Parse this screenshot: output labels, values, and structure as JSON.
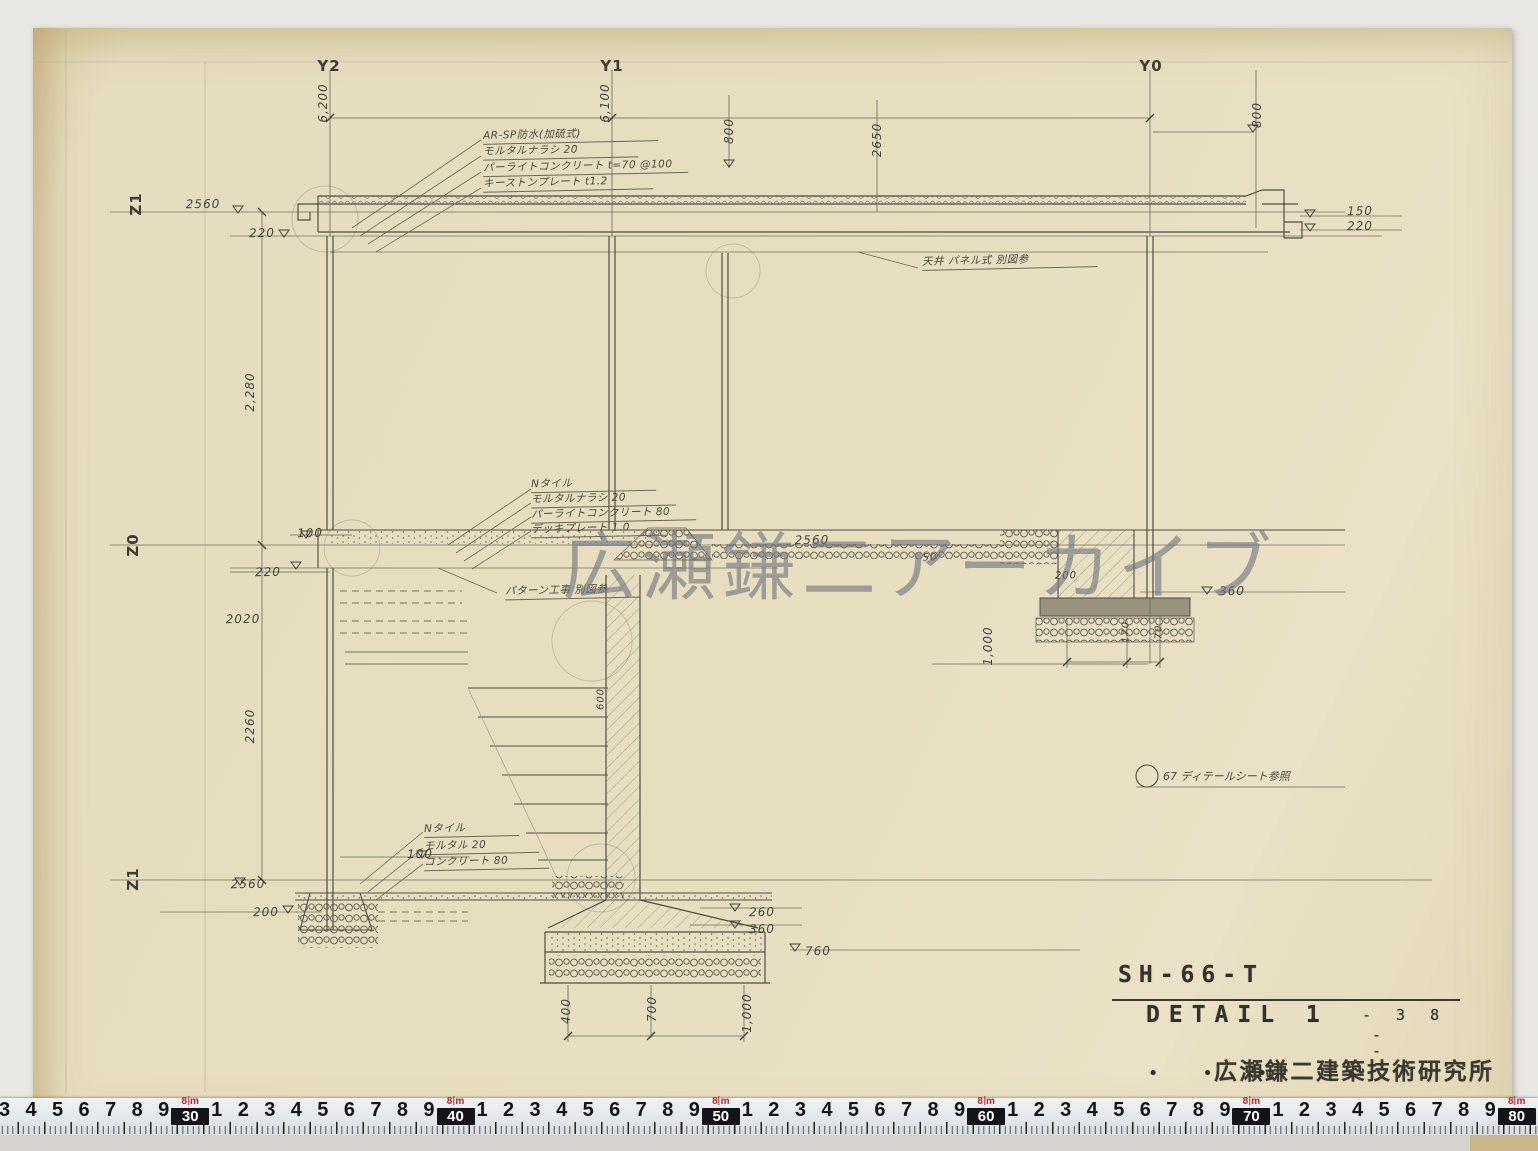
{
  "watermark": "広瀬鎌二アーカイブ",
  "grid": {
    "y2": "Y2",
    "y1": "Y1",
    "y0": "Y0",
    "z1_top": "Z1",
    "z0": "Z0",
    "z1_bot": "Z1"
  },
  "callouts": {
    "roof": [
      "AR-SP防水(加硫式)",
      "モルタルナラシ 20",
      "パーライトコンクリート t=70 @100",
      "キーストンプレート t1.2"
    ],
    "mid": [
      "Nタイル",
      "モルタルナラシ 20",
      "パーライトコンクリート 80",
      "デッキプレート 1.0"
    ],
    "ground": [
      "Nタイル",
      "モルタル 20",
      "コンクリート 80"
    ],
    "ceiling_note": "天井 パネル式 別図参",
    "pattern_note": "パターン工事 別図参",
    "detail_ref": "67 ディテールシート参照"
  },
  "dims": {
    "v6200": "6,200",
    "v6100": "6,100",
    "v800a": "800",
    "v2650": "2650",
    "v800b": "800",
    "r2560": "2560",
    "r220": "220",
    "tr150": "150",
    "tr220": "220",
    "u2280": "2,280",
    "m100": "100",
    "m220": "220",
    "m2560": "2560",
    "m50": "50",
    "m200": "200",
    "m360": "360",
    "m2020": "2020",
    "m1000": "1,000",
    "m170": "170",
    "m70": "70",
    "l2260": "2260",
    "s600": "600",
    "g100": "100",
    "g2560": "2560",
    "g200": "200",
    "g260": "260",
    "g360": "360",
    "g760": "760",
    "f400": "400",
    "f700": "700",
    "f1000": "1,000"
  },
  "title_block": {
    "code": "SH-66-T",
    "title": "DETAIL 1",
    "number": "- 3 8",
    "dash1": "-",
    "dash2": "-",
    "dots": "• • •",
    "firm": "広瀬鎌二建築技術研究所"
  },
  "ruler": {
    "meter": "8",
    "unit": "m",
    "tokens": [
      "3",
      "4",
      "5",
      "6",
      "7",
      "8",
      "9",
      "#30",
      "1",
      "2",
      "3",
      "4",
      "5",
      "6",
      "7",
      "8",
      "9",
      "#40",
      "1",
      "2",
      "3",
      "4",
      "5",
      "6",
      "7",
      "8",
      "9",
      "#50",
      "1",
      "2",
      "3",
      "4",
      "5",
      "6",
      "7",
      "8",
      "9",
      "#60",
      "1",
      "2",
      "3",
      "4",
      "5",
      "6",
      "7",
      "8",
      "9",
      "#70",
      "1",
      "2",
      "3",
      "4",
      "5",
      "6",
      "7",
      "8",
      "9",
      "#80"
    ]
  }
}
